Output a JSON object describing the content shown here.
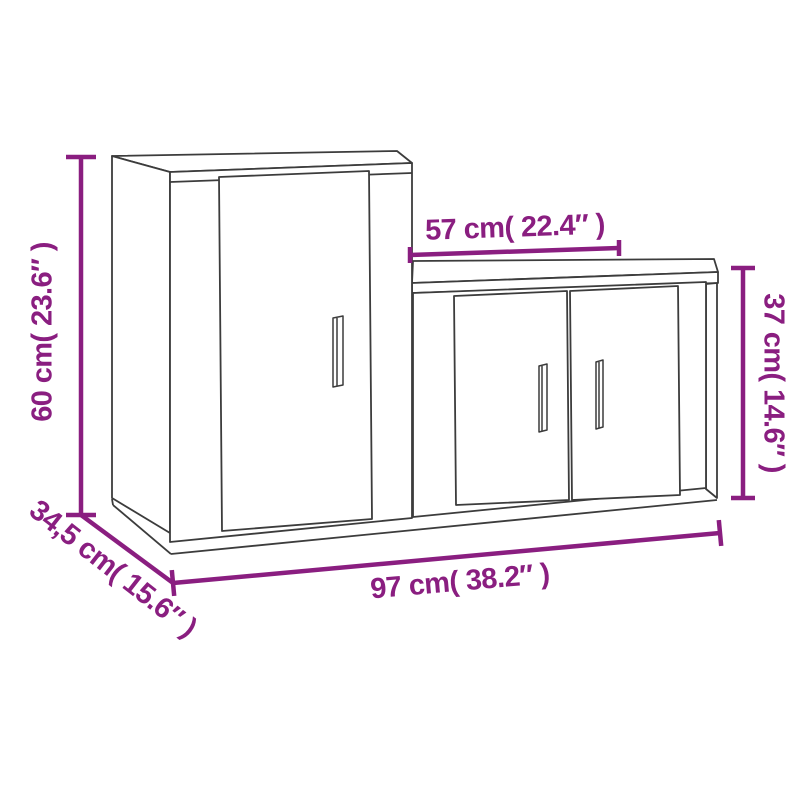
{
  "colors": {
    "dimension_accent": "#8A1E80",
    "furniture_outline": "#3C3C3C",
    "background": "#FFFFFF"
  },
  "dimensions": {
    "tall_cabinet_height": {
      "label": "60 cm( 23.6″ )",
      "cm": "60",
      "inch": "23.6″"
    },
    "low_cabinet_width": {
      "label": "57 cm( 22.4″ )",
      "cm": "57",
      "inch": "22.4″"
    },
    "low_cabinet_height": {
      "label": "37 cm( 14.6″ )",
      "cm": "37",
      "inch": "14.6″"
    },
    "total_width": {
      "label": "97 cm( 38.2″ )",
      "cm": "97",
      "inch": "38.2″"
    },
    "depth": {
      "label": "34,5 cm( 15.6″ )",
      "cm": "34,5",
      "inch": "15.6″"
    }
  }
}
